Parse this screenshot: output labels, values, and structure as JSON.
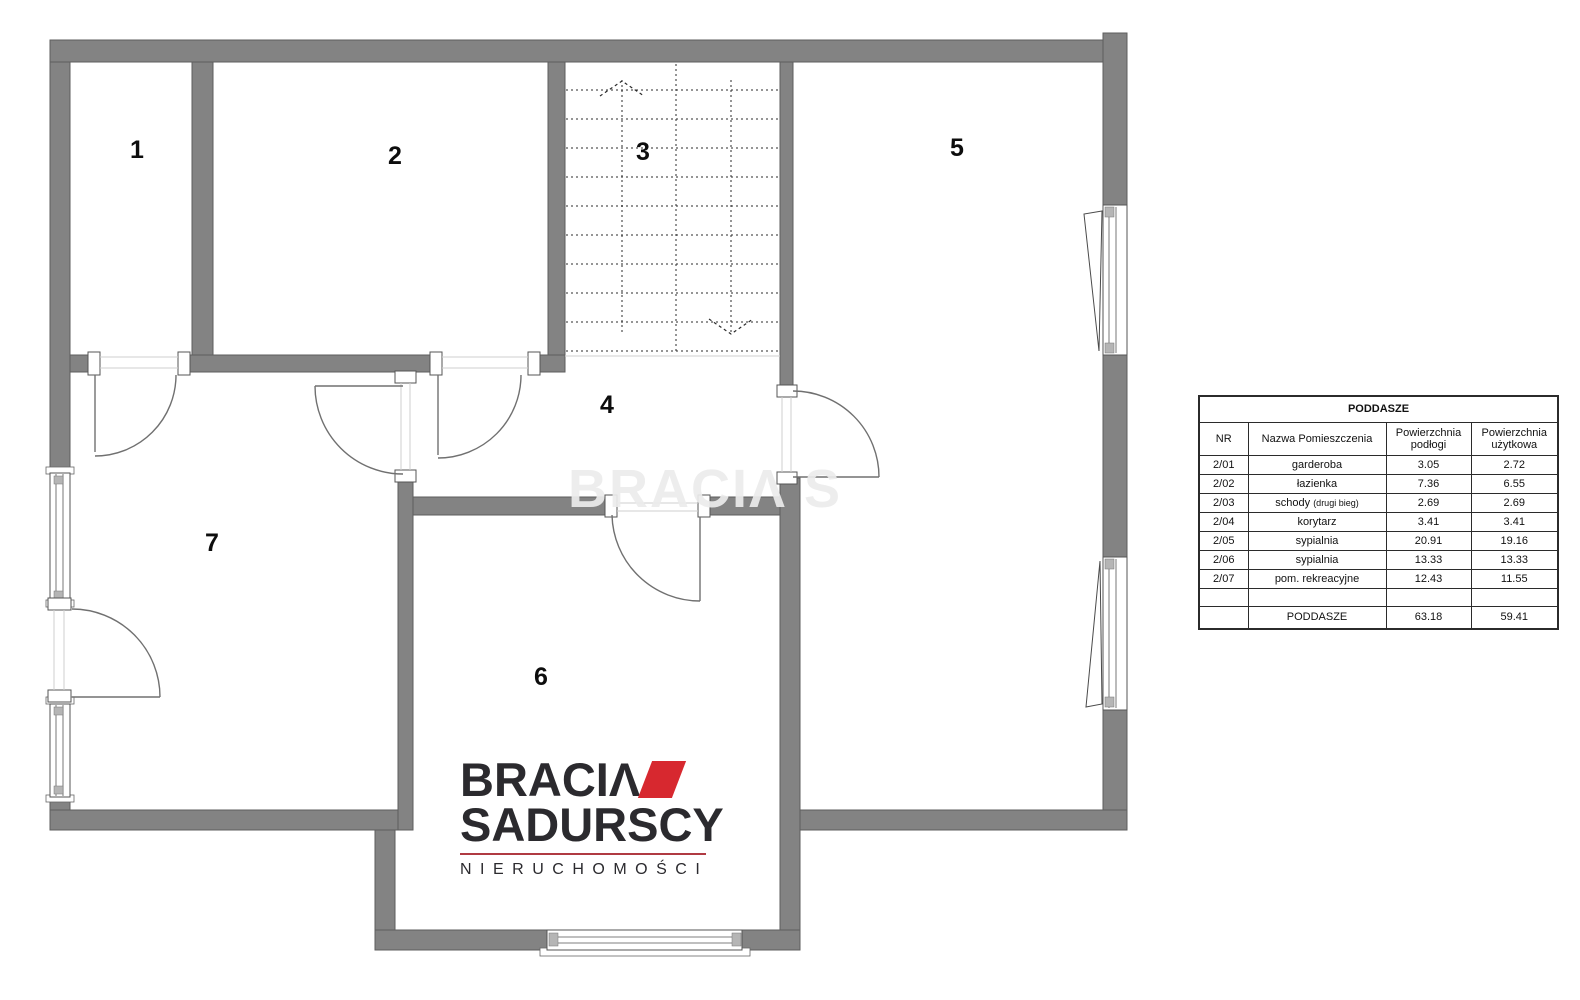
{
  "colors": {
    "wall": "#838383",
    "logo_red": "#d7282f",
    "logo_dark": "#2b2a2e"
  },
  "rooms": [
    {
      "number": "1"
    },
    {
      "number": "2"
    },
    {
      "number": "3"
    },
    {
      "number": "4"
    },
    {
      "number": "5"
    },
    {
      "number": "6"
    },
    {
      "number": "7"
    }
  ],
  "table": {
    "title": "PODDASZE",
    "headers": [
      "NR",
      "Nazwa Pomieszczenia",
      "Powierzchnia podłogi",
      "Powierzchnia użytkowa"
    ],
    "rows": [
      {
        "nr": "2/01",
        "name": "garderoba",
        "note": "",
        "floor": "3.05",
        "usable": "2.72"
      },
      {
        "nr": "2/02",
        "name": "łazienka",
        "note": "",
        "floor": "7.36",
        "usable": "6.55"
      },
      {
        "nr": "2/03",
        "name": "schody",
        "note": "(drugi bieg)",
        "floor": "2.69",
        "usable": "2.69"
      },
      {
        "nr": "2/04",
        "name": "korytarz",
        "note": "",
        "floor": "3.41",
        "usable": "3.41"
      },
      {
        "nr": "2/05",
        "name": "sypialnia",
        "note": "",
        "floor": "20.91",
        "usable": "19.16"
      },
      {
        "nr": "2/06",
        "name": "sypialnia",
        "note": "",
        "floor": "13.33",
        "usable": "13.33"
      },
      {
        "nr": "2/07",
        "name": "pom. rekreacyjne",
        "note": "",
        "floor": "12.43",
        "usable": "11.55"
      }
    ],
    "total": {
      "label": "PODDASZE",
      "floor": "63.18",
      "usable": "59.41"
    }
  },
  "logo": {
    "brand_top": "BRACIΛ",
    "brand_bottom": "SADURSCY",
    "tagline": "NIERUCHOMOŚCI"
  },
  "watermark": {
    "text": "BRACIΛ S"
  }
}
